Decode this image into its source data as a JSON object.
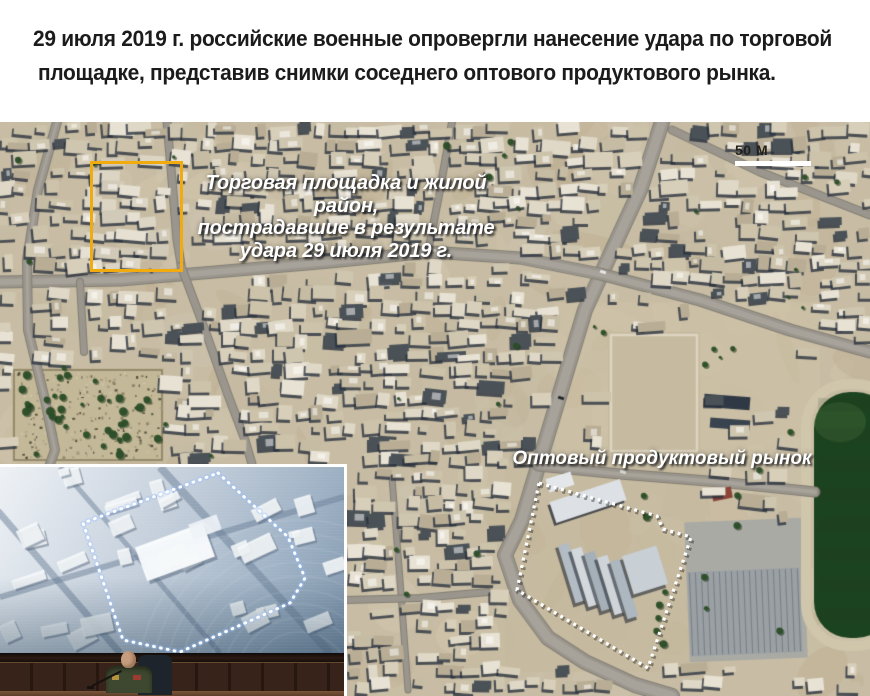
{
  "header": {
    "line1": "29 июля 2019 г. российские военные опровергли нанесение удара по торговой",
    "line2": "площадке, представив снимки соседнего оптового продуктового рынка."
  },
  "map": {
    "damage_annotation": {
      "line1": "Торговая площадка и жилой район,",
      "line2": "пострадавшие в результате",
      "line3": "удара 29 июля 2019 г."
    },
    "market_label": "Оптовый продуктовый рынок",
    "scale_label": "50 М",
    "colors": {
      "highlight_box": "#F2AB0F",
      "annotation_text": "#FFFFFF",
      "dotted_outline": "#FFFFFF",
      "scale_bar": "#FFFFFF"
    }
  }
}
